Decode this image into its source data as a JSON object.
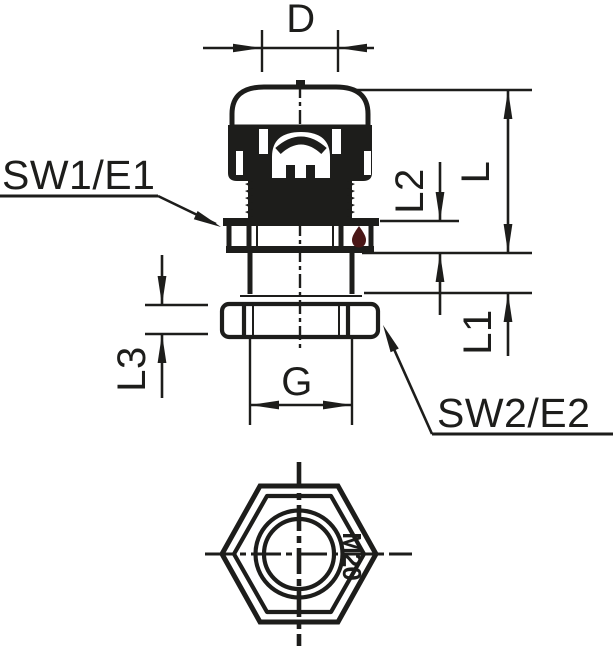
{
  "drawing": {
    "kind": "cable-gland dimensional drawing",
    "views": [
      "side-view",
      "bottom-view"
    ]
  },
  "labels": {
    "d": "D",
    "sw1": "SW1/E1",
    "sw2": "SW2/E2",
    "l": "L",
    "l1": "L1",
    "l2": "L2",
    "l3": "L3",
    "g": "G",
    "marking": "M20"
  },
  "colors": {
    "line": "#1d1d1b",
    "background": "#ffffff",
    "drop": "#4a1717"
  }
}
